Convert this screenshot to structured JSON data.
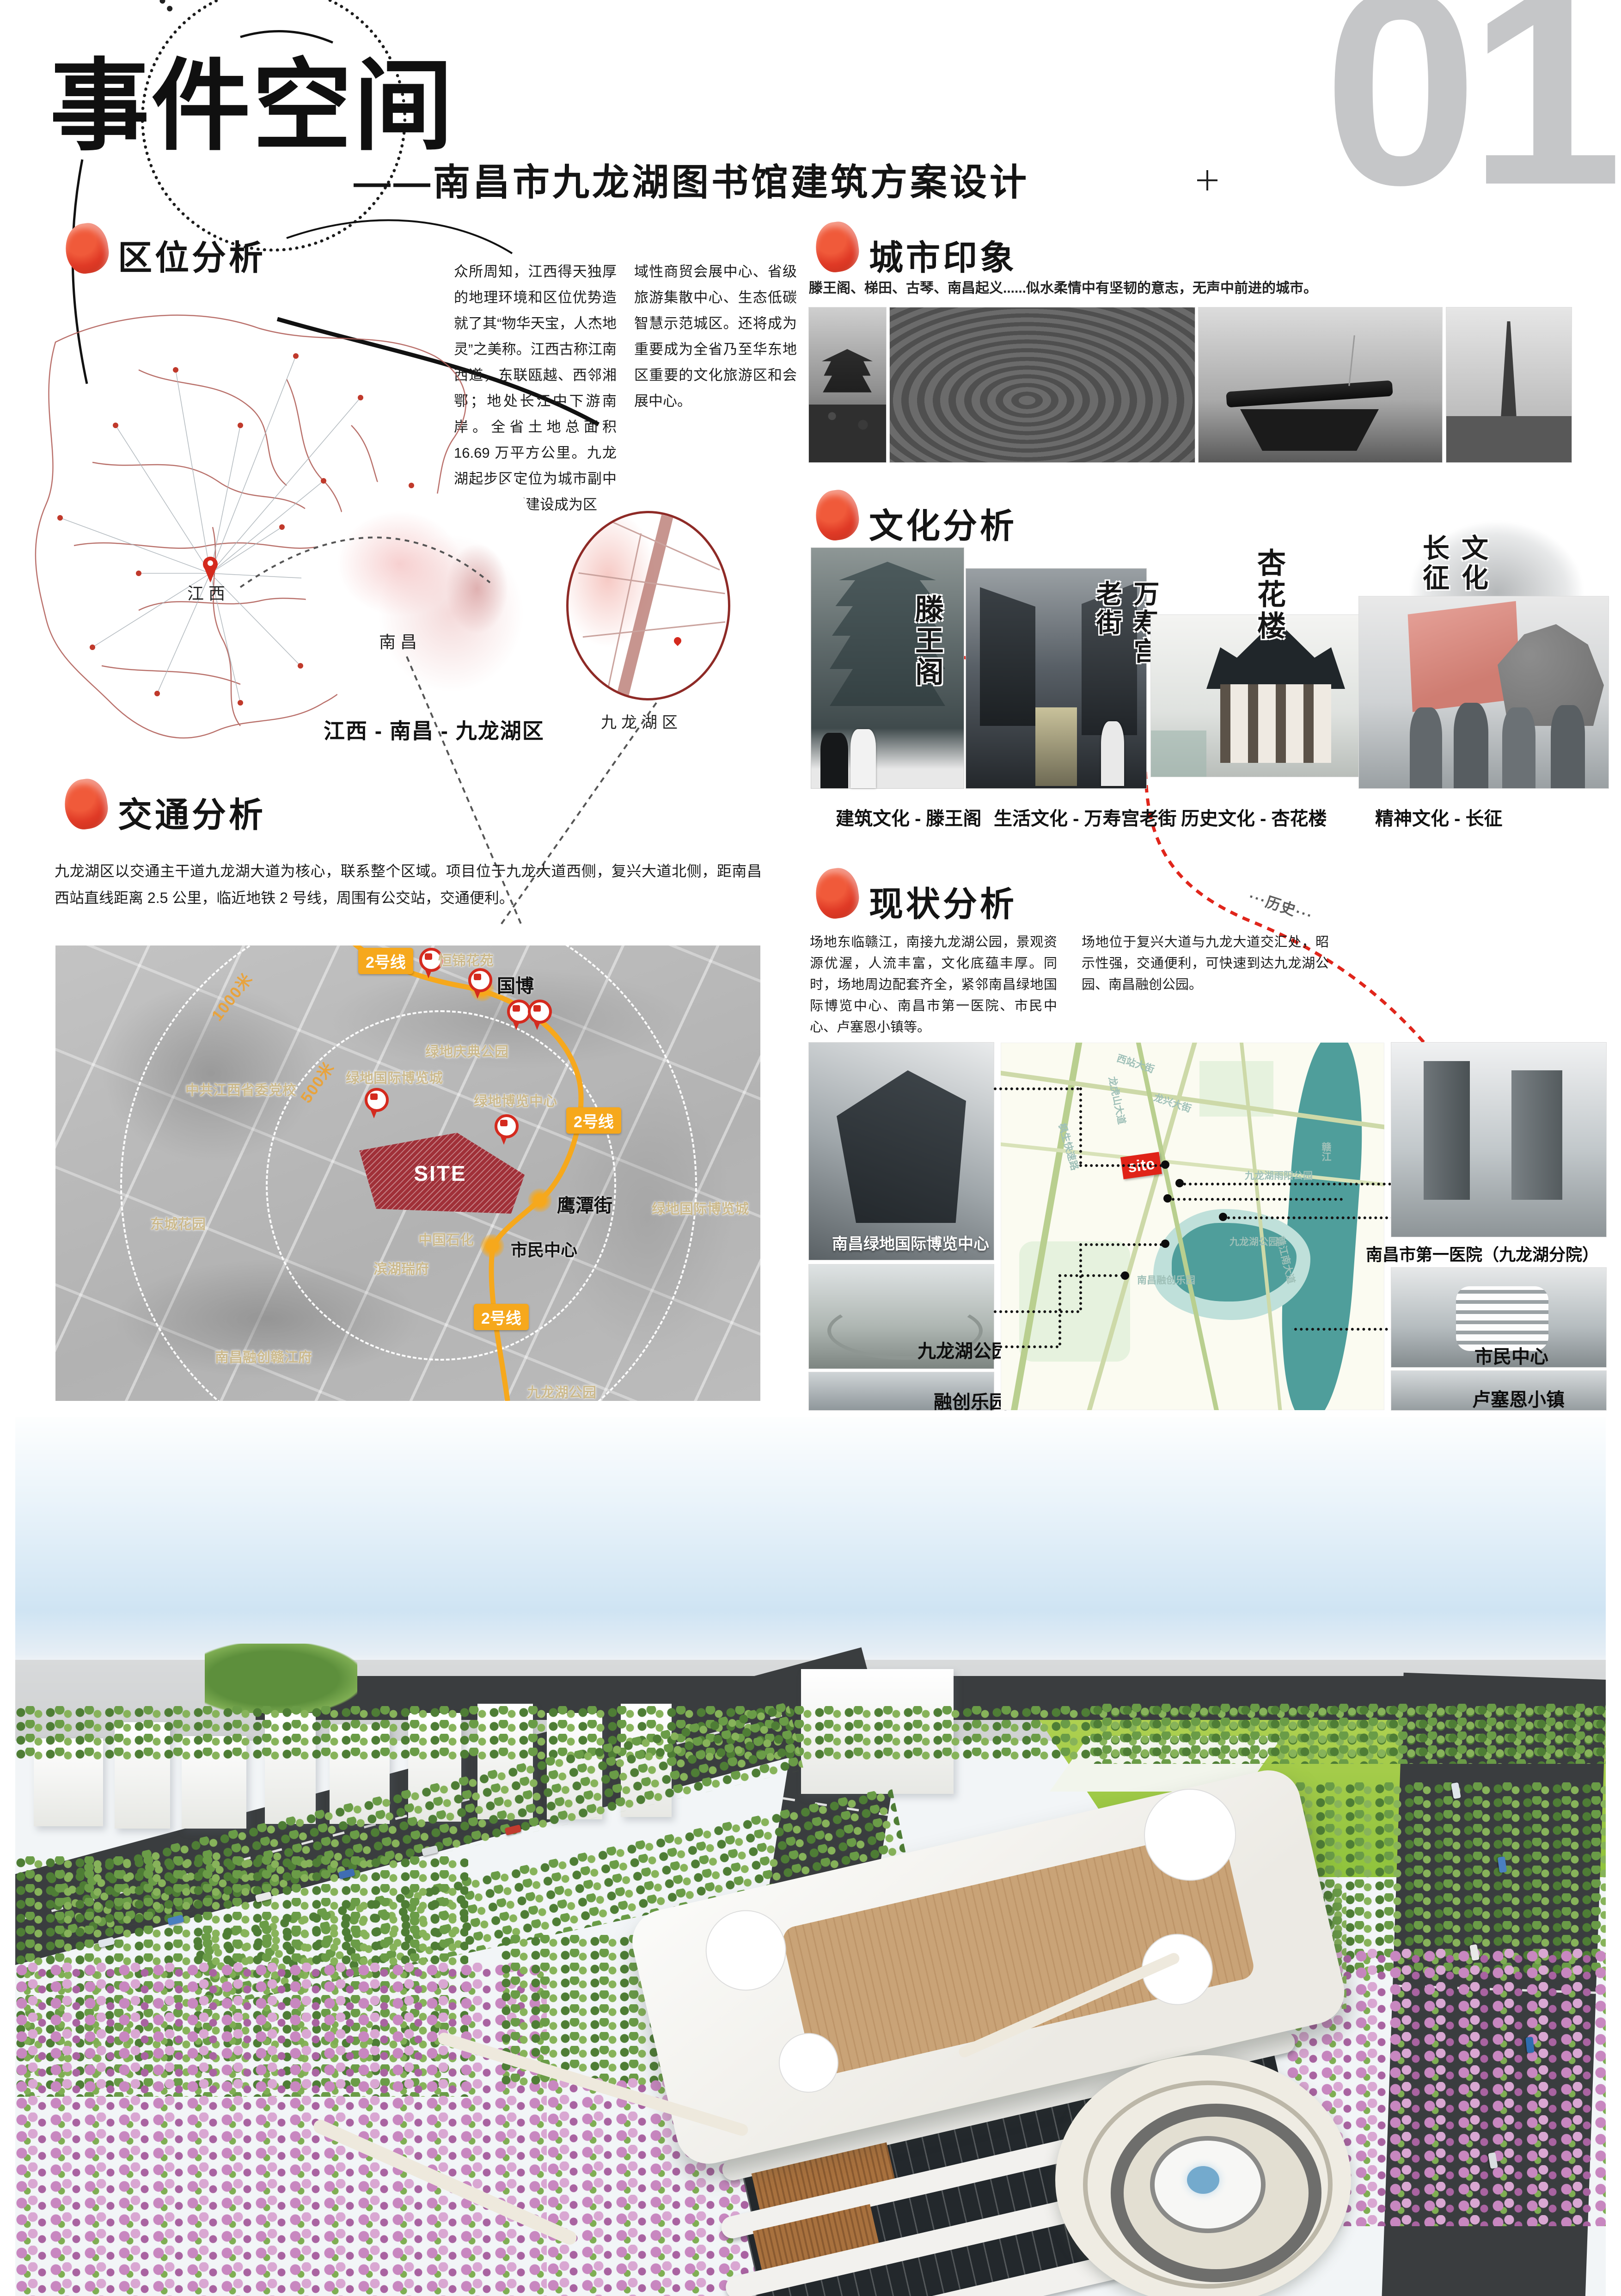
{
  "page": {
    "number": "01"
  },
  "header": {
    "title": "事件空间",
    "subtitle": "——南昌市九龙湖图书馆建筑方案设计"
  },
  "location": {
    "heading": "区位分析",
    "col1": "众所周知，江西得天独厚的地理环境和区位优势造就了其“物华天宝，人杰地灵”之美称。江西古称江南西道，东联瓯越、西邻湘鄂；地处长江中下游南岸。全省土地总面积 16.69 万平方公里。九龙湖起步区定位为城市副中心，将规划建设成为区",
    "col2": "域性商贸会展中心、省级旅游集散中心、生态低碳智慧示范城区。还将成为重要成为全省乃至华东地区重要的文化旅游区和会展中心。",
    "map": {
      "label_jiangxi": "江西",
      "label_nanchang": "南昌",
      "label_jiulonghu": "九龙湖区",
      "caption": "江西 - 南昌 - 九龙湖区"
    }
  },
  "impression": {
    "heading": "城市印象",
    "desc": "滕王阁、梯田、古琴、南昌起义......似水柔情中有坚韧的意志，无声中前进的城市。"
  },
  "culture": {
    "heading": "文化分析",
    "route_labels": [
      "···建筑···",
      "···生活···",
      "···历史···",
      "···精神···"
    ],
    "captions": [
      "建筑文化 - 滕王阁",
      "生活文化 - 万寿宫老街",
      "历史文化 - 杏花楼",
      "精神文化 - 长征"
    ],
    "calligraphy": [
      "滕王阁",
      "万寿宫老街",
      "杏花楼",
      "文化长征"
    ]
  },
  "traffic": {
    "heading": "交通分析",
    "desc": "九龙湖区以交通主干道九龙湖大道为核心，联系整个区域。项目位于九龙大道西侧，复兴大道北侧，距南昌西站直线距离 2.5 公里，临近地铁 2 号线，周围有公交站，交通便利。",
    "map": {
      "line_badge": "2号线",
      "radius_1000": "1000米",
      "radius_500": "500米",
      "site": "SITE",
      "stations": [
        "国博",
        "鹰潭街",
        "市民中心"
      ],
      "places": [
        "恒锦花苑",
        "中共江西省委党校",
        "绿地庆典公园",
        "绿地国际博览城",
        "绿地博览中心",
        "绿地国际博览城",
        "中国石化",
        "滨湖瑞府",
        "东城花园",
        "南昌融创赣江府",
        "九龙湖公园"
      ]
    }
  },
  "status": {
    "heading": "现状分析",
    "col1": "场地东临赣江，南接九龙湖公园，景观资源优渥，人流丰富，文化底蕴丰厚。同时，场地周边配套齐全，紧邻南昌绿地国际博览中心、南昌市第一医院、市民中心、卢塞恩小镇等。",
    "col2": "场地位于复兴大道与九龙大道交汇处，昭示性强，交通便利，可快速到达九龙湖公园、南昌融创公园。",
    "left_places": [
      "南昌绿地国际博览中心",
      "九龙湖公园",
      "融创乐园"
    ],
    "right_places": [
      "南昌市第一医院（九龙湖分院）",
      "市民中心",
      "卢塞恩小镇"
    ],
    "site_tag": "site",
    "map_minor": [
      "九龙湖雨阳公园",
      "九龙湖公园",
      "南昌融创乐园",
      "赣江"
    ]
  }
}
